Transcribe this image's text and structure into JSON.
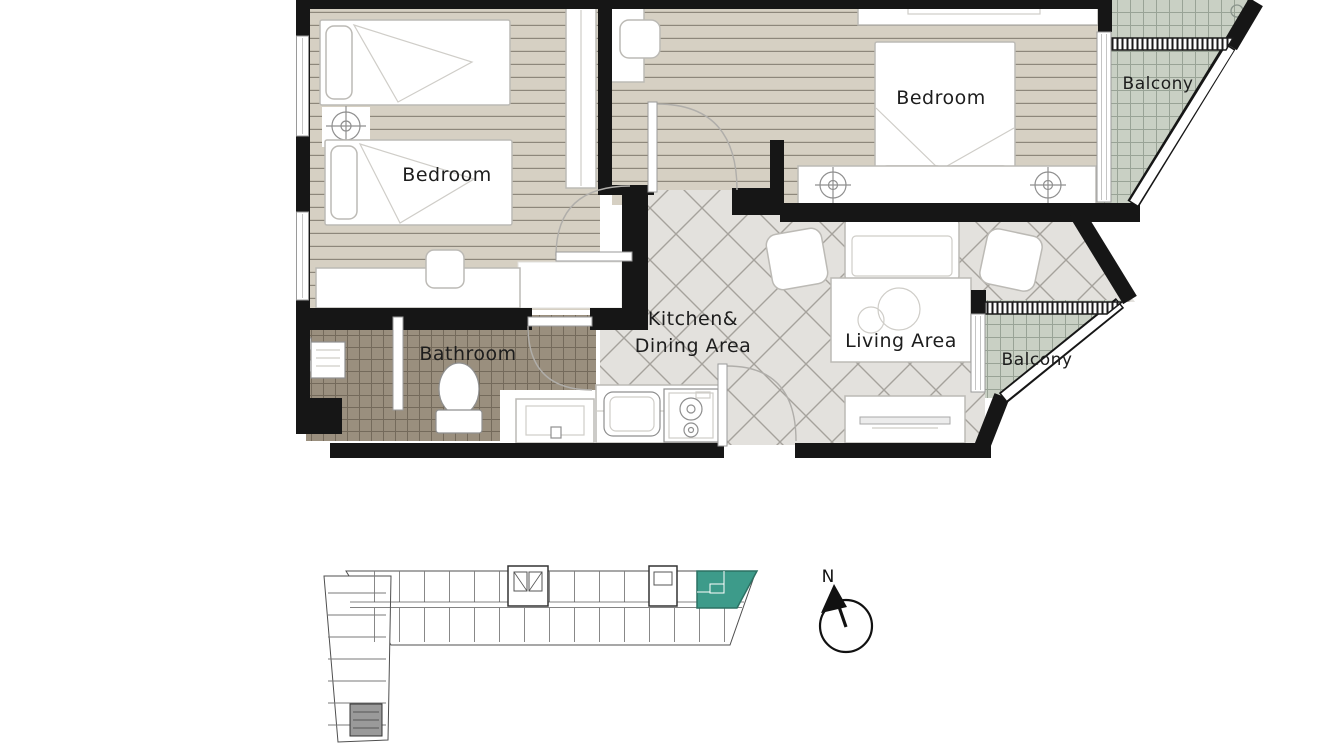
{
  "plan": {
    "rooms": {
      "bedroom_left": {
        "label": "Bedroom"
      },
      "bedroom_right": {
        "label": "Bedroom"
      },
      "bathroom": {
        "label": "Bathroom"
      },
      "kitchen_dining": {
        "line1": "Kitchen&",
        "line2": "Dining Area"
      },
      "living": {
        "label": "Living Area"
      },
      "balcony_upper": {
        "label": "Balcony"
      },
      "balcony_lower": {
        "label": "Balcony"
      }
    }
  },
  "compass": {
    "north": "N"
  },
  "colors": {
    "wall": "#161616",
    "wood_floor": "#d6d0c3",
    "wood_line": "#8d877b",
    "tile_floor": "#e3e1dd",
    "tile_line": "#a5a29c",
    "bath_floor": "#9a8f7e",
    "bath_line": "#746a5b",
    "balcony_floor": "#c9d0c4",
    "balcony_line": "#99a396",
    "unit_highlight": "#3d9b8a",
    "furniture_stroke": "#bcbab5",
    "label_text": "#1d1d1d"
  }
}
